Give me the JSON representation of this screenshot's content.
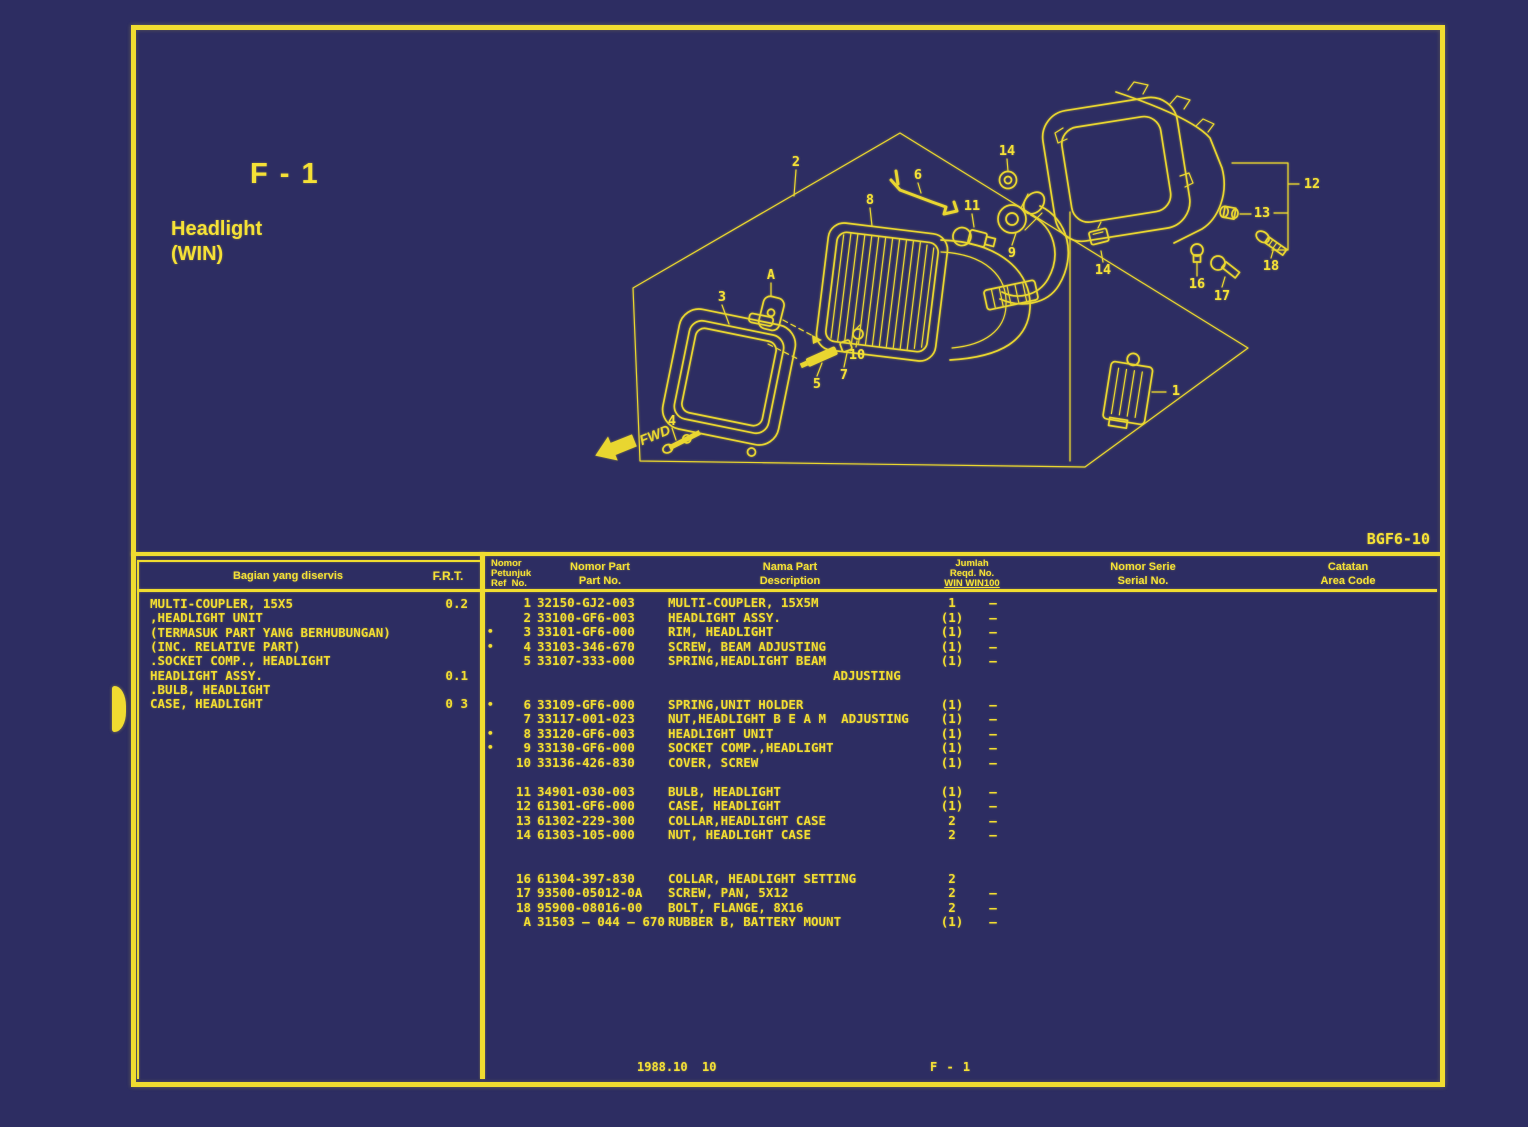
{
  "colors": {
    "background": "#2d2d62",
    "accent_yellow": "#f0dc30",
    "text_yellow": "#f5e136"
  },
  "page": {
    "code": "F - 1",
    "title_line1": "Headlight",
    "title_line2": "(WIN)",
    "doc_ref": "BGF6-10",
    "footer_date": "1988.10  10",
    "footer_code": "F - 1"
  },
  "diagram": {
    "fwd_label": "FWD",
    "callouts": [
      {
        "label": "2",
        "x": 796,
        "y": 162
      },
      {
        "label": "3",
        "x": 722,
        "y": 297
      },
      {
        "label": "A",
        "x": 771,
        "y": 275
      },
      {
        "label": "8",
        "x": 870,
        "y": 200
      },
      {
        "label": "6",
        "x": 918,
        "y": 175
      },
      {
        "label": "11",
        "x": 972,
        "y": 206
      },
      {
        "label": "14",
        "x": 1007,
        "y": 151
      },
      {
        "label": "9",
        "x": 1012,
        "y": 253
      },
      {
        "label": "5",
        "x": 817,
        "y": 384
      },
      {
        "label": "7",
        "x": 844,
        "y": 375
      },
      {
        "label": "10",
        "x": 857,
        "y": 355
      },
      {
        "label": "4",
        "x": 672,
        "y": 421
      },
      {
        "label": "12",
        "x": 1312,
        "y": 184
      },
      {
        "label": "13",
        "x": 1262,
        "y": 213
      },
      {
        "label": "14",
        "x": 1103,
        "y": 270
      },
      {
        "label": "16",
        "x": 1197,
        "y": 284
      },
      {
        "label": "17",
        "x": 1222,
        "y": 296
      },
      {
        "label": "18",
        "x": 1271,
        "y": 266
      },
      {
        "label": "1",
        "x": 1176,
        "y": 391
      }
    ]
  },
  "service_table": {
    "header_col1": "Bagian yang diservis",
    "header_col2": "F.R.T.",
    "rows": [
      {
        "text": "MULTI-COUPLER, 15X5",
        "frt": "0.2"
      },
      {
        "text": ",HEADLIGHT UNIT",
        "frt": ""
      },
      {
        "text": "(TERMASUK PART YANG BERHUBUNGAN)",
        "frt": ""
      },
      {
        "text": "(INC. RELATIVE PART)",
        "frt": ""
      },
      {
        "text": ".SOCKET COMP., HEADLIGHT",
        "frt": ""
      },
      {
        "text": "HEADLIGHT ASSY.",
        "frt": "0.1"
      },
      {
        "text": ".BULB, HEADLIGHT",
        "frt": ""
      },
      {
        "text": "CASE, HEADLIGHT",
        "frt": "0 3"
      }
    ]
  },
  "parts_table": {
    "headers": {
      "ref": [
        "Nomor",
        "Petunjuk",
        "Ref  No."
      ],
      "part_no": [
        "Nomor Part",
        "Part No."
      ],
      "description": [
        "Nama Part",
        "Description"
      ],
      "qty": [
        "Jumlah",
        "Reqd. No.",
        "WIN WIN100"
      ],
      "serial": [
        "Nomor Serie",
        "Serial No."
      ],
      "area": [
        "Catatan",
        "Area Code"
      ]
    },
    "rows": [
      {
        "b": "",
        "ref": "1",
        "part": "32150-GJ2-003",
        "desc": "MULTI-COUPLER, 15X5M",
        "win": "1",
        "win100": "—"
      },
      {
        "b": "",
        "ref": "2",
        "part": "33100-GF6-003",
        "desc": "HEADLIGHT ASSY.",
        "win": "(1)",
        "win100": "—"
      },
      {
        "b": "•",
        "ref": "3",
        "part": "33101-GF6-000",
        "desc": "RIM, HEADLIGHT",
        "win": "(1)",
        "win100": "—"
      },
      {
        "b": "•",
        "ref": "4",
        "part": "33103-346-670",
        "desc": "SCREW, BEAM ADJUSTING",
        "win": "(1)",
        "win100": "—"
      },
      {
        "b": "",
        "ref": "5",
        "part": "33107-333-000",
        "desc": "SPRING,HEADLIGHT BEAM",
        "win": "(1)",
        "win100": "—",
        "desc2": "ADJUSTING"
      },
      {
        "b": "•",
        "ref": "6",
        "part": "33109-GF6-000",
        "desc": "SPRING,UNIT HOLDER",
        "win": "(1)",
        "win100": "—",
        "pre": 1
      },
      {
        "b": "",
        "ref": "7",
        "part": "33117-001-023",
        "desc": "NUT,HEADLIGHT B E A M  ADJUSTING",
        "win": "(1)",
        "win100": "—"
      },
      {
        "b": "•",
        "ref": "8",
        "part": "33120-GF6-003",
        "desc": "HEADLIGHT UNIT",
        "win": "(1)",
        "win100": "—"
      },
      {
        "b": "•",
        "ref": "9",
        "part": "33130-GF6-000",
        "desc": "SOCKET COMP.,HEADLIGHT",
        "win": "(1)",
        "win100": "—"
      },
      {
        "b": "",
        "ref": "10",
        "part": "33136-426-830",
        "desc": "COVER, SCREW",
        "win": "(1)",
        "win100": "—"
      },
      {
        "b": "",
        "ref": "11",
        "part": "34901-030-003",
        "desc": "BULB, HEADLIGHT",
        "win": "(1)",
        "win100": "—",
        "pre": 1
      },
      {
        "b": "",
        "ref": "12",
        "part": "61301-GF6-000",
        "desc": "CASE, HEADLIGHT",
        "win": "(1)",
        "win100": "—"
      },
      {
        "b": "",
        "ref": "13",
        "part": "61302-229-300",
        "desc": "COLLAR,HEADLIGHT CASE",
        "win": "2",
        "win100": "—"
      },
      {
        "b": "",
        "ref": "14",
        "part": "61303-105-000",
        "desc": "NUT, HEADLIGHT CASE",
        "win": "2",
        "win100": "—"
      },
      {
        "b": "",
        "ref": "16",
        "part": "61304-397-830",
        "desc": "COLLAR, HEADLIGHT SETTING",
        "win": "2",
        "win100": "",
        "pre": 2
      },
      {
        "b": "",
        "ref": "17",
        "part": "93500-05012-0A",
        "desc": "SCREW, PAN, 5X12",
        "win": "2",
        "win100": "—"
      },
      {
        "b": "",
        "ref": "18",
        "part": "95900-08016-00",
        "desc": "BOLT, FLANGE, 8X16",
        "win": "2",
        "win100": "—"
      },
      {
        "b": "",
        "ref": "A",
        "part": "31503 — 044 — 670",
        "desc": "RUBBER B, BATTERY MOUNT",
        "win": "(1)",
        "win100": "—"
      }
    ]
  }
}
